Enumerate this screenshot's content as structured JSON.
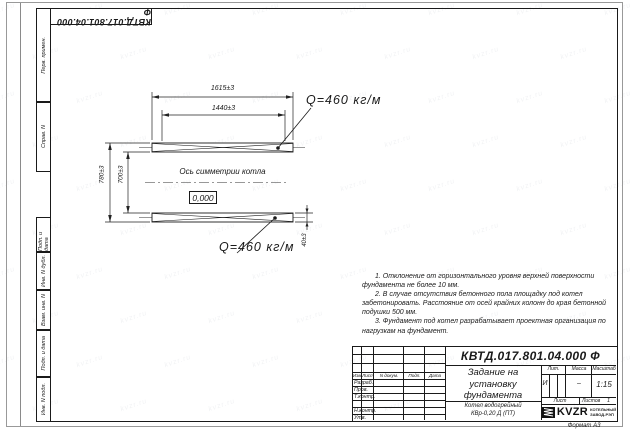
{
  "watermark": {
    "text": "kvzr.ru"
  },
  "corner_stamp": {
    "designation": "КВТД.017.801.04.000 Ф"
  },
  "margin": {
    "perv_primen": "Перв. примен.",
    "sprav_n": "Справ. N",
    "podp_data_1": "Подп. и дата",
    "inv_n_dubl": "Инв. N дубл.",
    "vzam_inv_n": "Взам. инв. N",
    "podp_data_2": "Подп. и дата",
    "inv_n_podl": "Инв. N подл."
  },
  "drawing": {
    "dim_top_outer": "1615±3",
    "dim_top_inner": "1440±3",
    "dim_left_outer": "780±3",
    "dim_left_inner": "700±3",
    "dim_beam_height": "40±3",
    "load_label_top": "Q=460 кг/м",
    "load_label_bottom": "Q=460 кг/м",
    "symmetry_axis_label": "Ось симметрии котла",
    "level_mark": "0,000"
  },
  "notes": {
    "lines": [
      "1. Отклонение от горизонтального уровня верхней поверхности",
      "фундамента не более 10 мм.",
      "2. В случае отсутствия бетонного пола площадку под котел",
      "забетонировать. Расстояние от осей крайних колонн до края бетонной",
      "подушки 500 мм.",
      "3. Фундамент под котел разрабатывает проектная организация по",
      "нагрузкам на фундамент."
    ]
  },
  "title_block": {
    "designation": "КВТД.017.801.04.000 Ф",
    "title_lines": [
      "Задание на",
      "установку",
      "фундамента"
    ],
    "product_lines": [
      "Котел водогрейный",
      "КВр-0,20 Д (ПТ)"
    ],
    "columns": [
      "Изм.",
      "Лист",
      "N докум.",
      "Подп.",
      "Дата"
    ],
    "rows": [
      "Разраб.",
      "Пров.",
      "Т.контр.",
      "",
      "Н.контр.",
      "Утв."
    ],
    "lit_label": "Лит.",
    "lit_value": "И",
    "mass_label": "Масса",
    "mass_value": "–",
    "scale_label": "Масштаб",
    "scale_value": "1:15",
    "sheet_label": "Лист",
    "sheets_label": "Листов",
    "sheets_value": "1",
    "logo": {
      "name": "KVZR",
      "sub1": "КОТЕЛЬНЫЙ",
      "sub2": "ЗАВОД-РЭП"
    },
    "format": "Формат А3"
  }
}
